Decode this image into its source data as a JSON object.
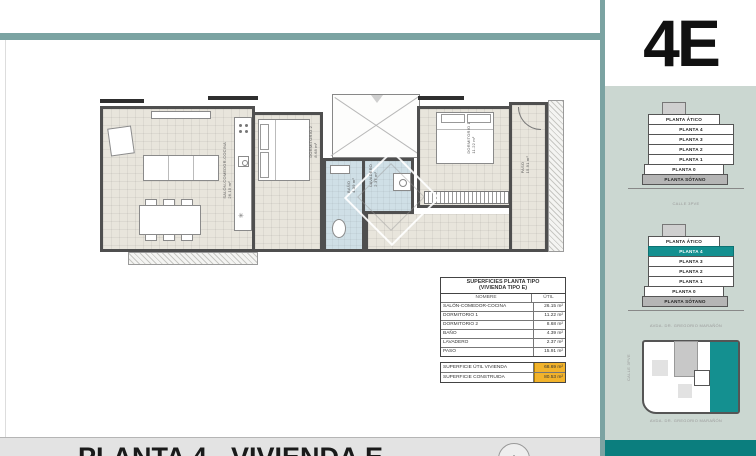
{
  "unit_code": "4E",
  "colors": {
    "accent_teal": "#149090",
    "divider_teal": "#7ba3a2",
    "dark_teal_bar": "#0b7e7e",
    "panel_green": "#cbd7d1",
    "highlight_amber": "#f2b32b"
  },
  "title_bar": {
    "title": "PLANTA 4 - VIVIENDA E",
    "zoom_label": "+"
  },
  "surfaces_table": {
    "title_line1": "SUPERFICIES PLANTA TIPO",
    "title_line2": "(VIVIENDA TIPO E)",
    "columns": {
      "name": "NOMBRE",
      "util": "ÚTIL"
    },
    "rows": [
      {
        "name": "SALÓN-COMEDOR-COCINA",
        "util": "26.15 m²"
      },
      {
        "name": "DORMITORIO 1",
        "util": "11.22 m²"
      },
      {
        "name": "DORMITORIO 2",
        "util": "8.68 m²"
      },
      {
        "name": "BAÑO",
        "util": "4.39 m²"
      },
      {
        "name": "LAVADERO",
        "util": "2.37 m²"
      },
      {
        "name": "PASO",
        "util": "15.91 m²"
      }
    ],
    "totals": [
      {
        "name": "SUPERFICIE ÚTIL VIVIENDA",
        "util": "68.69 m²"
      },
      {
        "name": "SUPERFICIE CONSTRUIDA",
        "util": "80.53 m²"
      }
    ]
  },
  "floor_plan": {
    "rooms": [
      {
        "label": "SALÓN-COMEDOR-COCINA",
        "area": "26.15 m²"
      },
      {
        "label": "DORMITORIO 2",
        "area": "8.68 m²"
      },
      {
        "label": "DORMITORIO 1",
        "area": "11.22 m²"
      },
      {
        "label": "BAÑO",
        "area": "4.39 m²"
      },
      {
        "label": "LAVADERO",
        "area": "2.37 m²"
      },
      {
        "label": "PASO",
        "area": "15.91 m²"
      }
    ]
  },
  "location_panel": {
    "elevation_plain": {
      "floors": [
        "PLANTA ÁTICO",
        "PLANTA 4",
        "PLANTA 3",
        "PLANTA 2",
        "PLANTA 1",
        "PLANTA 0",
        "PLANTA SÓTANO"
      ],
      "street": "CALLE 3PVE"
    },
    "elevation_highlighted": {
      "floors": [
        "PLANTA ÁTICO",
        "PLANTA 4",
        "PLANTA 3",
        "PLANTA 2",
        "PLANTA 1",
        "PLANTA 0",
        "PLANTA SÓTANO"
      ],
      "highlighted_floor": "PLANTA 4",
      "street": "AVDA. DR. GREGORIO MARAÑÓN"
    },
    "site_plan": {
      "street_left": "CALLE 3PVE",
      "street_bottom": "AVDA. DR. GREGORIO MARAÑÓN"
    }
  }
}
